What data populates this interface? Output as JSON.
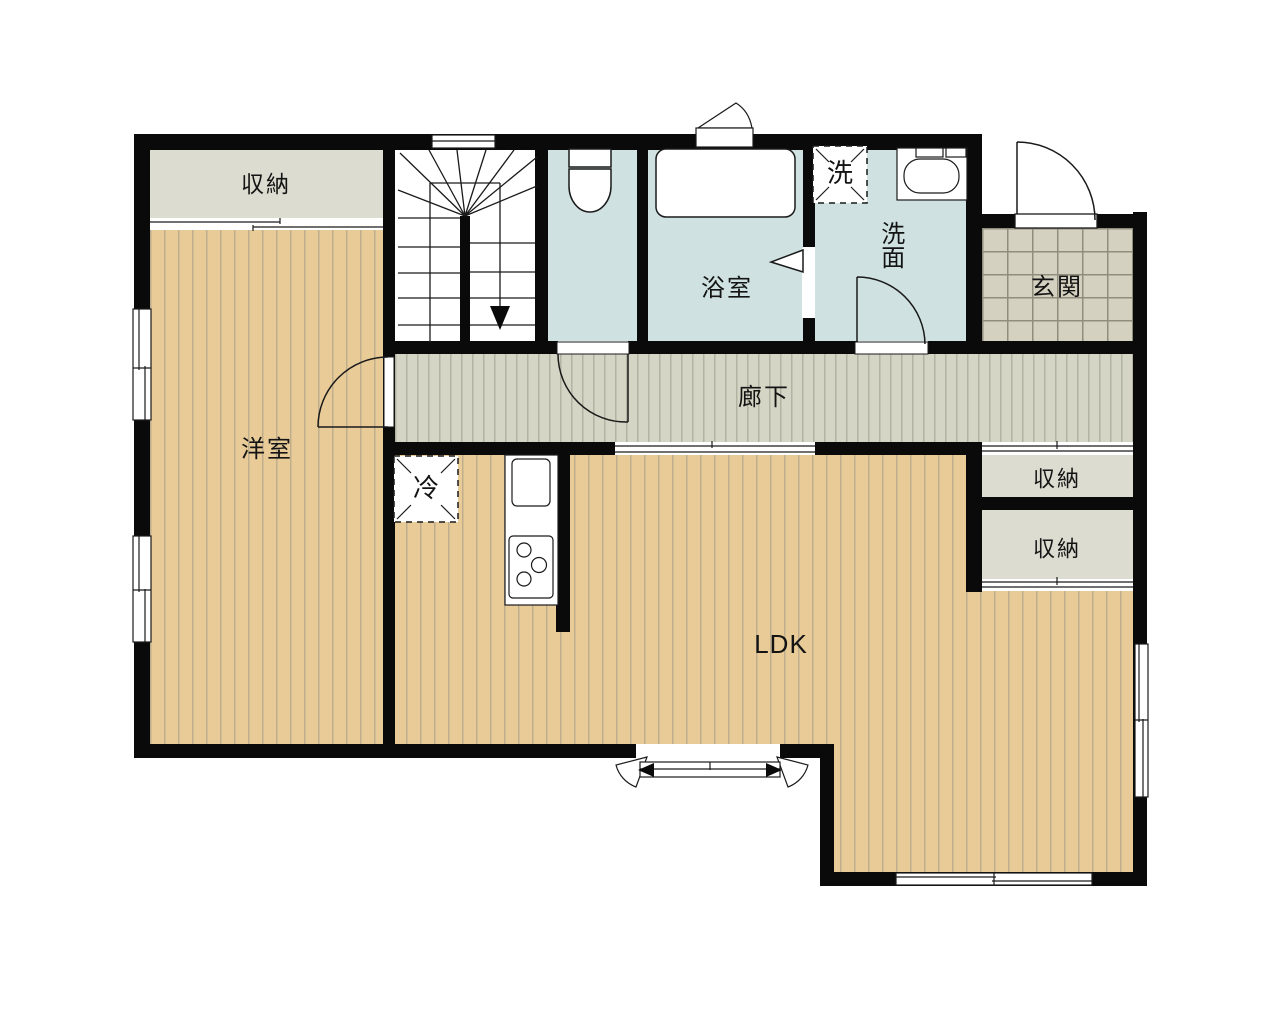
{
  "rooms": {
    "storage_top_left": "収納",
    "western_room": "洋室",
    "bathroom": "浴室",
    "washroom": "洗面",
    "washing_machine": "洗",
    "entrance": "玄関",
    "hallway": "廊下",
    "refrigerator": "冷",
    "storage_right_upper": "収納",
    "storage_right_lower": "収納",
    "ldk": "LDK"
  },
  "colors": {
    "wall": "#0a0a0a",
    "wood_floor": "#e9cb98",
    "hallway_floor": "#d5d5c5",
    "entrance_tile": "#d4d1c0",
    "wet_area": "#cfe2e1",
    "storage_floor": "#dcddd0"
  }
}
